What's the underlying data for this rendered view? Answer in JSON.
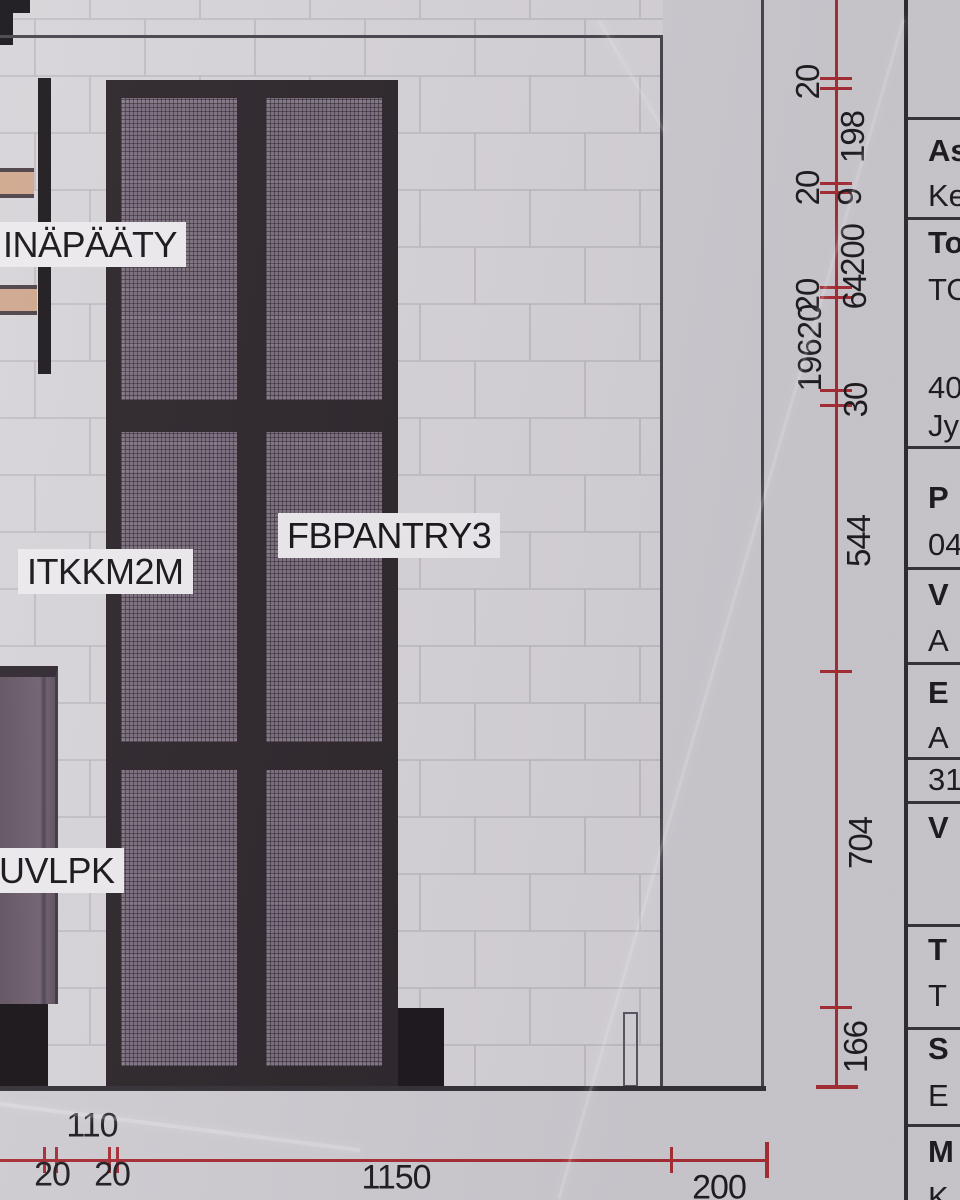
{
  "labels": {
    "wall_end": "INÄPÄÄTY",
    "cabinet_left": "ITKKM2M",
    "pantry": "FBPANTRY3",
    "cabinet_lower": "UVLPK"
  },
  "dimensions": {
    "vertical": [
      "20",
      "198",
      "20",
      "9",
      "200",
      "64",
      "20",
      "19620",
      "30",
      "544",
      "704",
      "166"
    ],
    "bottom": [
      "110",
      "20",
      "20",
      "1150",
      "200"
    ]
  },
  "title_block": {
    "rows": [
      {
        "label": "As",
        "bold": true
      },
      {
        "label": "Ke",
        "bold": false
      },
      {
        "label": "To",
        "bold": true
      },
      {
        "label": "TO",
        "bold": false
      },
      {
        "label": "40",
        "bold": false
      },
      {
        "label": "Jy",
        "bold": false
      },
      {
        "label": "P",
        "bold": true
      },
      {
        "label": "04",
        "bold": false
      },
      {
        "label": "V",
        "bold": true
      },
      {
        "label": "A",
        "bold": false
      },
      {
        "label": "E",
        "bold": true
      },
      {
        "label": "A",
        "bold": false
      },
      {
        "label": "31",
        "bold": false
      },
      {
        "label": "V",
        "bold": true
      },
      {
        "label": "T",
        "bold": true
      },
      {
        "label": "T",
        "bold": false
      },
      {
        "label": "S",
        "bold": true
      },
      {
        "label": "E",
        "bold": false
      },
      {
        "label": "M",
        "bold": true
      },
      {
        "label": "K",
        "bold": false
      }
    ]
  },
  "colors": {
    "dimension_red": "#a82c33",
    "ink": "#1d1a1e",
    "paper": "#cfccd2",
    "wall_tile": "#d7d4d9",
    "mesh_panel": "#796c7c",
    "cabinet_frame": "#2a2328",
    "wood_trim": "#cfa78d",
    "label_chip": "#eceaed"
  }
}
